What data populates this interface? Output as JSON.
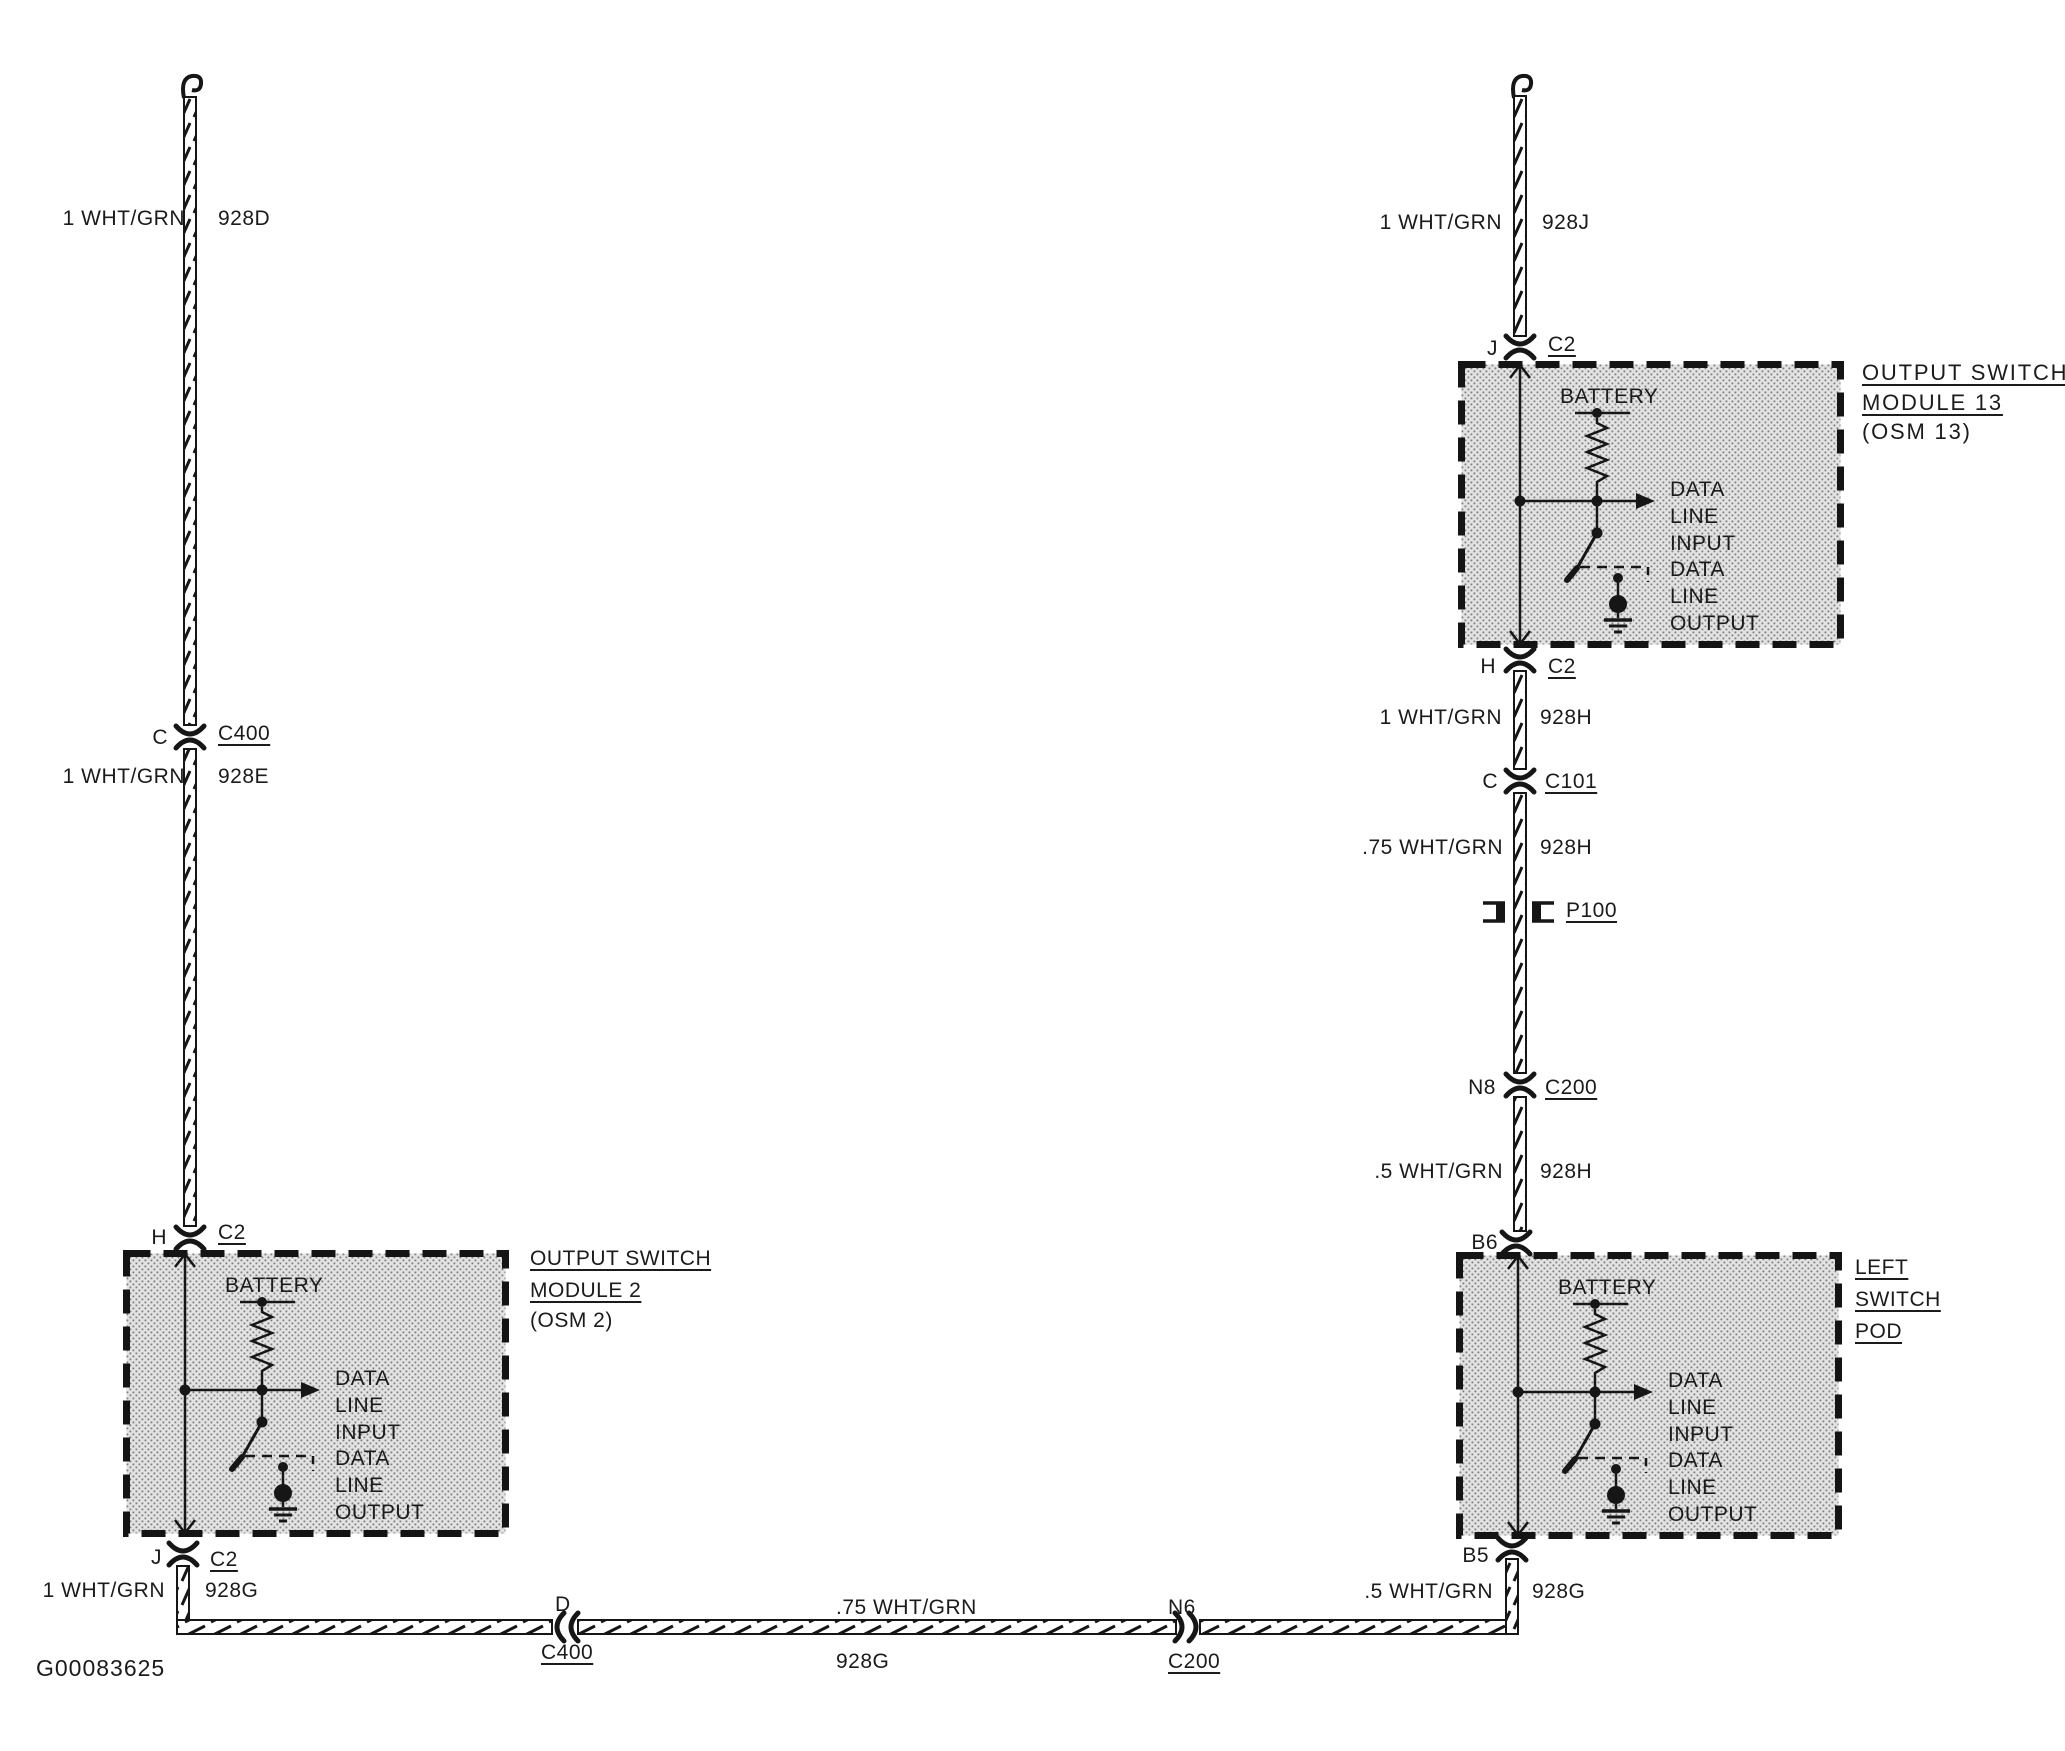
{
  "figure_id": "G00083625",
  "module_internal": {
    "battery": "BATTERY",
    "lines": [
      "DATA",
      "LINE",
      "INPUT",
      "DATA",
      "LINE",
      "OUTPUT"
    ]
  },
  "modules": {
    "osm13": {
      "title": [
        "OUTPUT SWITCH",
        "MODULE 13",
        "(OSM 13)"
      ]
    },
    "osm2": {
      "title": [
        "OUTPUT SWITCH",
        "MODULE 2",
        "(OSM 2)"
      ]
    },
    "left_switch_pod": {
      "title": [
        "LEFT",
        "SWITCH",
        "POD"
      ]
    }
  },
  "wire_labels": {
    "w928d": {
      "spec": "1 WHT/GRN",
      "circuit": "928D"
    },
    "w928e": {
      "spec": "1 WHT/GRN",
      "circuit": "928E"
    },
    "w928g_left": {
      "spec": "1 WHT/GRN",
      "circuit": "928G"
    },
    "w928g_mid": {
      "spec": ".75 WHT/GRN",
      "circuit": "928G"
    },
    "w928g_right": {
      "spec": ".5 WHT/GRN",
      "circuit": "928G"
    },
    "w928j": {
      "spec": "1 WHT/GRN",
      "circuit": "928J"
    },
    "w928h_1": {
      "spec": "1 WHT/GRN",
      "circuit": "928H"
    },
    "w928h_2": {
      "spec": ".75 WHT/GRN",
      "circuit": "928H"
    },
    "w928h_3": {
      "spec": ".5 WHT/GRN",
      "circuit": "928H"
    }
  },
  "connectors": {
    "c400_left": {
      "pin": "C",
      "name": "C400"
    },
    "c2_osm2_top": {
      "pin": "H",
      "name": "C2"
    },
    "c2_osm2_bottom": {
      "pin": "J",
      "name": "C2"
    },
    "c400_bottom": {
      "pin": "D",
      "name": "C400"
    },
    "c200_bottom": {
      "pin": "N6",
      "name": "C200"
    },
    "b5": {
      "pin": "B5"
    },
    "b6": {
      "pin": "B6"
    },
    "c2_osm13_top": {
      "pin": "J",
      "name": "C2"
    },
    "c2_osm13_bottom": {
      "pin": "H",
      "name": "C2"
    },
    "c101": {
      "pin": "C",
      "name": "C101"
    },
    "p100": {
      "name": "P100"
    },
    "c200_right": {
      "pin": "N8",
      "name": "C200"
    }
  }
}
